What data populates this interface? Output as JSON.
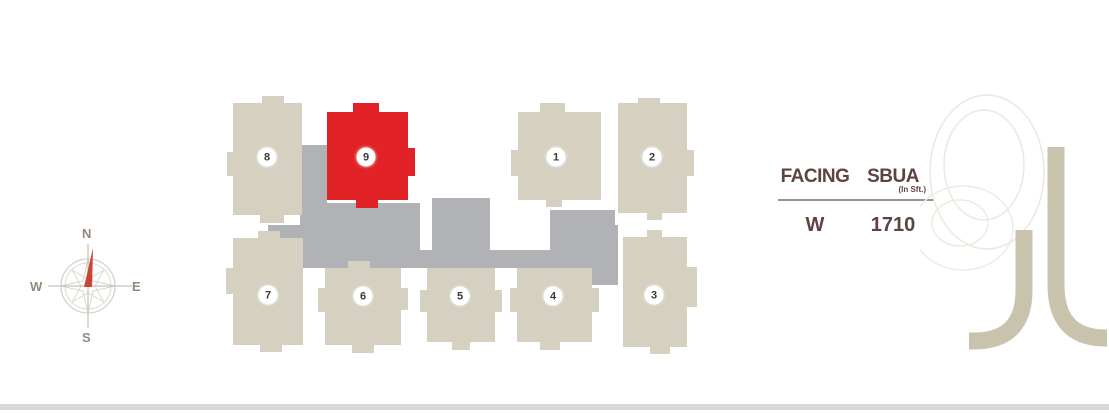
{
  "compass": {
    "north": "N",
    "east": "E",
    "south": "S",
    "west": "W",
    "needle_color": "#c94534",
    "ring_color": "#d5d1c9",
    "label_color": "#93897c"
  },
  "site_plan": {
    "colors": {
      "building": "#d5d0c0",
      "highlight": "#e12328",
      "podium": "#b0b2b5",
      "number_bg": "#ffffff",
      "number_text": "#3d3a35"
    },
    "podium": [
      [
        300,
        145,
        27,
        123
      ],
      [
        327,
        203,
        93,
        65
      ],
      [
        432,
        198,
        58,
        70
      ],
      [
        268,
        225,
        60,
        43
      ],
      [
        268,
        250,
        347,
        18
      ],
      [
        550,
        210,
        65,
        58
      ],
      [
        590,
        225,
        28,
        60
      ]
    ],
    "buildings": [
      {
        "label": "8",
        "x": 233,
        "y": 103,
        "w": 69,
        "h": 112,
        "badge_x": 34,
        "badge_y": 54,
        "highlighted": false,
        "tabs": [
          [
            -6,
            49,
            6,
            24
          ],
          [
            29,
            -7,
            22,
            7
          ],
          [
            27,
            112,
            24,
            8
          ]
        ]
      },
      {
        "label": "9",
        "x": 327,
        "y": 112,
        "w": 81,
        "h": 88,
        "badge_x": 39,
        "badge_y": 45,
        "highlighted": true,
        "tabs": [
          [
            26,
            -9,
            26,
            9
          ],
          [
            81,
            36,
            7,
            28
          ],
          [
            29,
            88,
            22,
            8
          ]
        ]
      },
      {
        "label": "1",
        "x": 518,
        "y": 112,
        "w": 83,
        "h": 88,
        "badge_x": 38,
        "badge_y": 45,
        "highlighted": false,
        "tabs": [
          [
            22,
            -9,
            25,
            9
          ],
          [
            -7,
            38,
            7,
            26
          ],
          [
            28,
            88,
            16,
            7
          ]
        ]
      },
      {
        "label": "2",
        "x": 618,
        "y": 103,
        "w": 69,
        "h": 110,
        "badge_x": 34,
        "badge_y": 54,
        "highlighted": false,
        "tabs": [
          [
            20,
            -5,
            22,
            5
          ],
          [
            69,
            47,
            7,
            26
          ],
          [
            29,
            110,
            15,
            7
          ]
        ]
      },
      {
        "label": "7",
        "x": 233,
        "y": 238,
        "w": 70,
        "h": 107,
        "badge_x": 35,
        "badge_y": 57,
        "highlighted": false,
        "tabs": [
          [
            -7,
            30,
            7,
            26
          ],
          [
            25,
            -7,
            22,
            7
          ],
          [
            27,
            107,
            22,
            7
          ]
        ]
      },
      {
        "label": "6",
        "x": 325,
        "y": 268,
        "w": 76,
        "h": 77,
        "badge_x": 38,
        "badge_y": 28,
        "highlighted": false,
        "tabs": [
          [
            -7,
            20,
            7,
            24
          ],
          [
            23,
            -7,
            22,
            7
          ],
          [
            27,
            77,
            22,
            8
          ],
          [
            76,
            20,
            7,
            22
          ]
        ]
      },
      {
        "label": "5",
        "x": 427,
        "y": 268,
        "w": 68,
        "h": 74,
        "badge_x": 33,
        "badge_y": 28,
        "highlighted": false,
        "tabs": [
          [
            -7,
            22,
            7,
            22
          ],
          [
            68,
            22,
            7,
            22
          ],
          [
            25,
            74,
            18,
            8
          ]
        ]
      },
      {
        "label": "4",
        "x": 517,
        "y": 268,
        "w": 75,
        "h": 74,
        "badge_x": 36,
        "badge_y": 28,
        "highlighted": false,
        "tabs": [
          [
            -7,
            20,
            7,
            24
          ],
          [
            75,
            20,
            7,
            24
          ],
          [
            23,
            74,
            20,
            8
          ]
        ]
      },
      {
        "label": "3",
        "x": 623,
        "y": 237,
        "w": 64,
        "h": 110,
        "badge_x": 31,
        "badge_y": 58,
        "highlighted": false,
        "tabs": [
          [
            64,
            30,
            10,
            40
          ],
          [
            24,
            -7,
            15,
            7
          ],
          [
            27,
            110,
            20,
            7
          ]
        ]
      }
    ]
  },
  "info_table": {
    "col1_header": "FACING",
    "col2_header": "SBUA",
    "col2_subheader": "(In Sft.)",
    "row": {
      "facing": "W",
      "sbua": "1710"
    },
    "text_color": "#5e4441"
  },
  "watermark": {
    "digit": "9",
    "outline_color": "#ebe8df",
    "stroke_color": "#c9c3ae"
  }
}
